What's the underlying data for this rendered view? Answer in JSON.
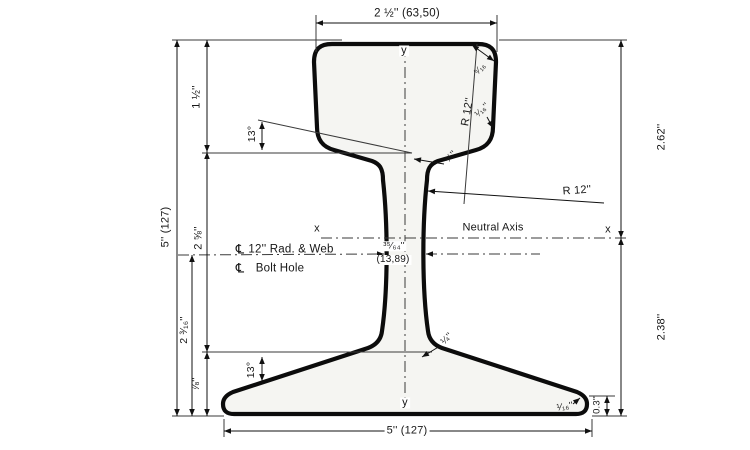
{
  "drawing": {
    "dimensions": {
      "head_width": "2 ½'' (63,50)",
      "overall_height": "5'' (127)",
      "head_depth": "1 ½''",
      "cl_to_base": "2 ⅝''",
      "web_span": "2 ³⁄₁₆''",
      "base_depth": "⅞''",
      "height_above_na": "2.62''",
      "height_below_na": "2.38''",
      "base_edge_height": "0.3''",
      "base_width": "5'' (127)",
      "web_thickness_in": "³⁵⁄₆₄''",
      "web_thickness_mm": "(13,89)",
      "head_corner_radius": "⁵⁄₁₆",
      "head_side_offset": "¹⁄₁₆''",
      "head_fillet_radius": "¼''",
      "base_fillet_radius": "¼''",
      "base_edge_radius": "¹⁄₁₆''",
      "head_slope_angle": "13°",
      "base_slope_angle": "13°",
      "head_radius": "R 12''",
      "web_radius": "R 12''"
    },
    "annotations": {
      "neutral_axis": "Neutral Axis",
      "axis_x": "x",
      "axis_y": "y",
      "centerline_symbol": "℄",
      "centerline_rad_web": "12'' Rad. & Web",
      "centerline_bolt_hole": "Bolt Hole"
    }
  }
}
